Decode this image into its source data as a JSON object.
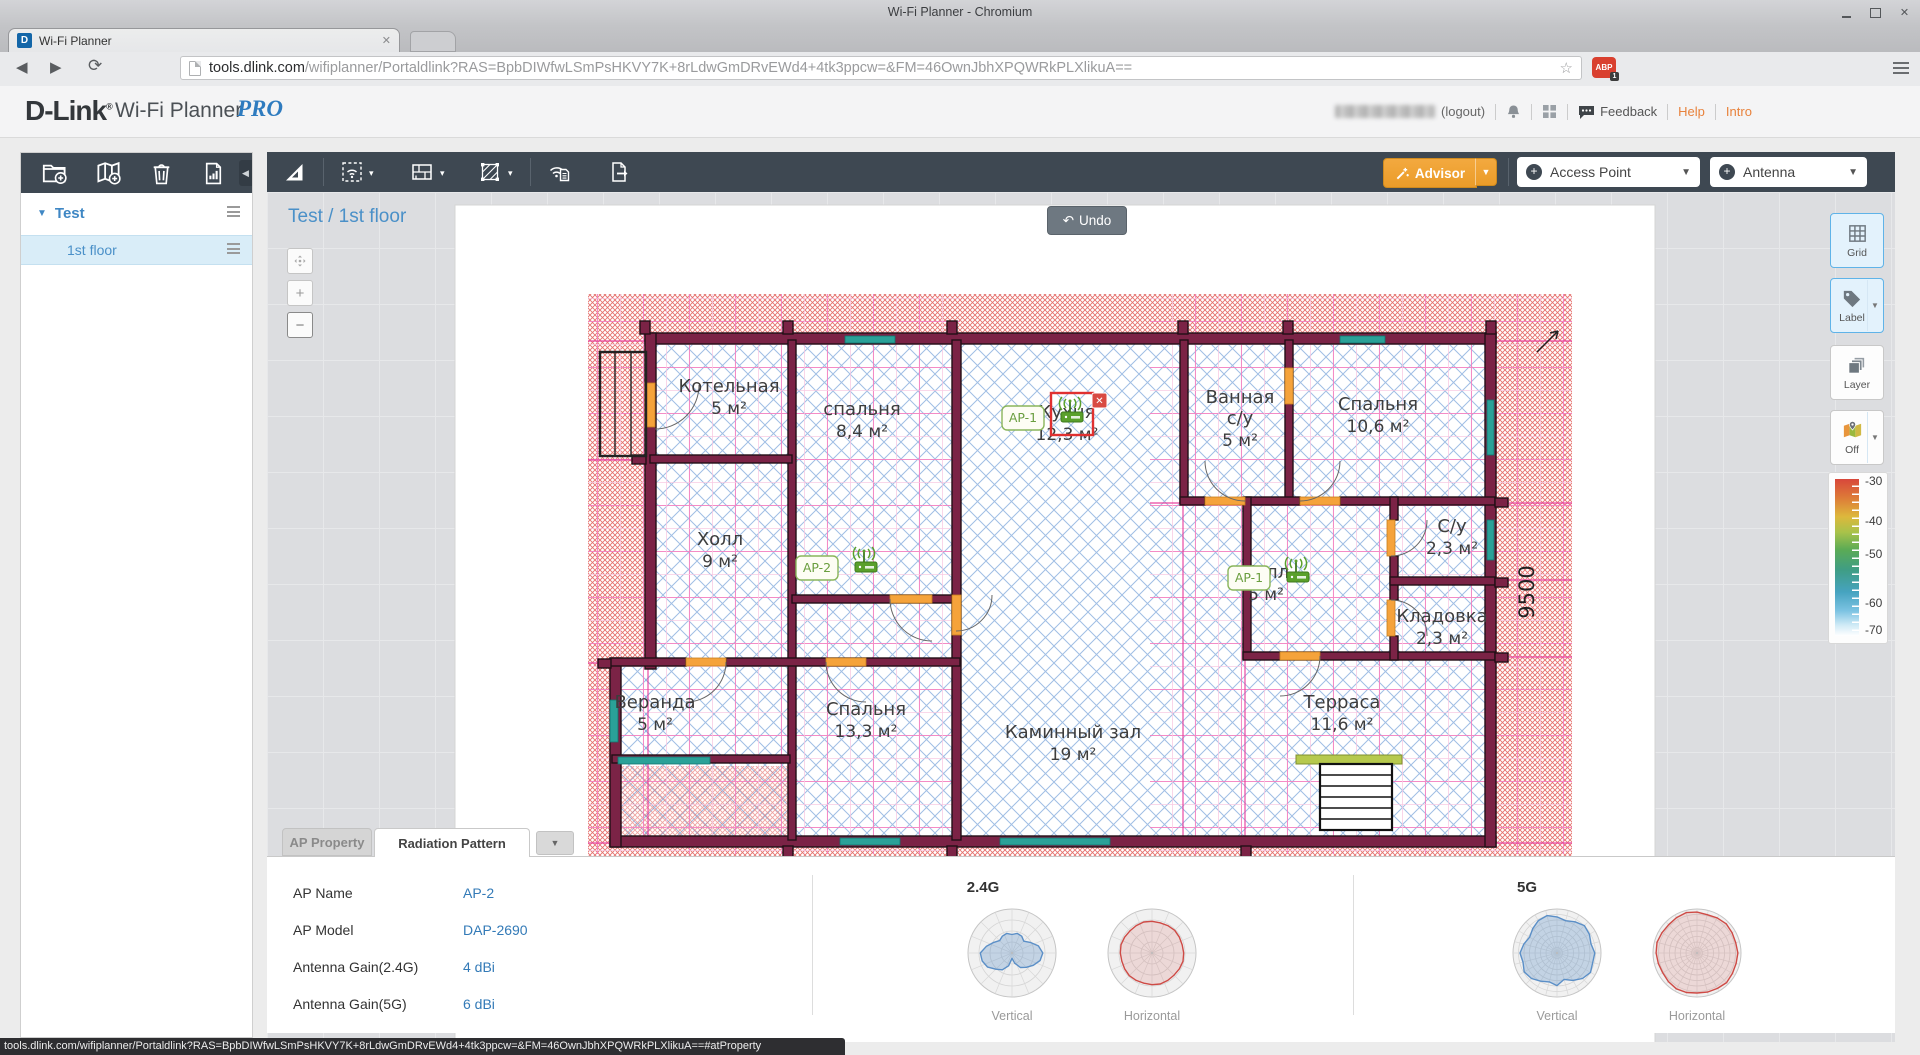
{
  "window": {
    "title": "Wi-Fi Planner - Chromium"
  },
  "browser": {
    "tab_title": "Wi-Fi Planner",
    "url_host": "tools.dlink.com",
    "url_path": "/wifiplanner/Portaldlink?RAS=BpbDIWfwLSmPsHKVY7K+8rLdwGmDRvEWd4+4tk3ppcw=&FM=46OwnJbhXPQWRkPLXlikuA==",
    "abp_label": "ABP",
    "abp_badge": "1"
  },
  "header": {
    "logo": "D-Link",
    "product": "Wi-Fi Planner",
    "edition": "PRO",
    "logout_label": "(logout)",
    "feedback_label": "Feedback",
    "help_label": "Help",
    "intro_label": "Intro"
  },
  "sidebar": {
    "project_label": "Test",
    "floor_label": "1st floor"
  },
  "toolbar": {
    "advisor_label": "Advisor",
    "access_point_label": "Access Point",
    "antenna_label": "Antenna"
  },
  "canvas": {
    "breadcrumb": "Test / 1st floor",
    "undo_label": "Undo"
  },
  "right_panel": {
    "grid_label": "Grid",
    "label_label": "Label",
    "layer_label": "Layer",
    "off_label": "Off",
    "scale_ticks": [
      "-30",
      "-40",
      "-50",
      "-60",
      "-70"
    ]
  },
  "plan": {
    "dimension": "9500",
    "rooms": [
      {
        "name": "Котельная",
        "area": "5 м²",
        "x": 729,
        "y": 392
      },
      {
        "name": "спальня",
        "area": "8,4 м²",
        "x": 862,
        "y": 415
      },
      {
        "name": "Кухня",
        "area": "12,3 м²",
        "x": 1067,
        "y": 418
      },
      {
        "name": "Ванная",
        "name2": "с/у",
        "area": "5 м²",
        "x": 1240,
        "y": 403
      },
      {
        "name": "Спальня",
        "area": "10,6 м²",
        "x": 1378,
        "y": 410
      },
      {
        "name": "Холл",
        "area": "9 м²",
        "x": 720,
        "y": 545
      },
      {
        "name": "Холл",
        "area": "5 м²",
        "x": 1266,
        "y": 578
      },
      {
        "name": "С/у",
        "area": "2,3 м²",
        "x": 1452,
        "y": 532
      },
      {
        "name": "Кладовка",
        "area": "2,3 м²",
        "x": 1442,
        "y": 622
      },
      {
        "name": "Веранда",
        "area": "5 м²",
        "x": 655,
        "y": 708
      },
      {
        "name": "Спальня",
        "area": "13,3 м²",
        "x": 866,
        "y": 715
      },
      {
        "name": "Каминный зал",
        "area": "19 м²",
        "x": 1073,
        "y": 738
      },
      {
        "name": "Терраса",
        "area": "11,6 м²",
        "x": 1342,
        "y": 708
      }
    ],
    "aps": [
      {
        "label": "AP-1",
        "x": 1072,
        "y": 418,
        "selected": true
      },
      {
        "label": "AP-2",
        "x": 866,
        "y": 568,
        "selected": false
      },
      {
        "label": "AP-1",
        "x": 1298,
        "y": 578,
        "selected": false
      }
    ]
  },
  "panel": {
    "tab_ap_property": "AP Property",
    "tab_radiation": "Radiation Pattern",
    "fields": [
      {
        "label": "AP Name",
        "value": "AP-2"
      },
      {
        "label": "AP Model",
        "value": "DAP-2690"
      },
      {
        "label": "Antenna Gain(2.4G)",
        "value": "4 dBi"
      },
      {
        "label": "Antenna Gain(5G)",
        "value": "6 dBi"
      }
    ],
    "sections": [
      {
        "title": "2.4G"
      },
      {
        "title": "5G"
      }
    ],
    "vertical_label": "Vertical",
    "horizontal_label": "Horizontal"
  },
  "chart_data": {
    "type": "radar",
    "title": "Antenna radiation patterns for DAP-2690",
    "charts": [
      {
        "band": "2.4G",
        "orientation": "Vertical",
        "rings": 4,
        "spokes": 16,
        "color": "#5b8fc7",
        "fill": "rgba(91,143,199,0.30)",
        "radii": [
          0.7,
          0.62,
          0.48,
          0.38,
          0.44,
          0.46,
          0.42,
          0.46,
          0.44,
          0.4,
          0.48,
          0.6,
          0.72,
          0.7,
          0.64,
          0.52,
          0.44,
          0.3,
          0.12,
          0.24,
          0.38,
          0.46,
          0.56,
          0.66
        ]
      },
      {
        "band": "2.4G",
        "orientation": "Horizontal",
        "rings": 4,
        "spokes": 16,
        "color": "#ce4a45",
        "fill": "rgba(206,74,69,0.15)",
        "radii": [
          0.72,
          0.71,
          0.72,
          0.73,
          0.72,
          0.71,
          0.72,
          0.73,
          0.72,
          0.71,
          0.72,
          0.73,
          0.72,
          0.71,
          0.72,
          0.73,
          0.72,
          0.71,
          0.72,
          0.73,
          0.72,
          0.71,
          0.72,
          0.73
        ]
      },
      {
        "band": "5G",
        "orientation": "Vertical",
        "rings": 8,
        "spokes": 24,
        "color": "#5b8fc7",
        "fill": "rgba(91,143,199,0.30)",
        "radii": [
          0.86,
          0.8,
          0.85,
          0.88,
          0.82,
          0.76,
          0.82,
          0.88,
          0.85,
          0.78,
          0.72,
          0.78,
          0.84,
          0.8,
          0.86,
          0.82,
          0.74,
          0.68,
          0.74,
          0.62,
          0.72,
          0.82,
          0.88,
          0.84
        ]
      },
      {
        "band": "5G",
        "orientation": "Horizontal",
        "rings": 8,
        "spokes": 24,
        "color": "#ce4a45",
        "fill": "rgba(206,74,69,0.15)",
        "radii": [
          0.93,
          0.91,
          0.92,
          0.94,
          0.92,
          0.9,
          0.93,
          0.95,
          0.93,
          0.91,
          0.92,
          0.94,
          0.93,
          0.91,
          0.9,
          0.92,
          0.94,
          0.93,
          0.91,
          0.92,
          0.93,
          0.95,
          0.93,
          0.92
        ]
      }
    ]
  },
  "statusbar": {
    "text": "tools.dlink.com/wifiplanner/Portaldlink?RAS=BpbDIWfwLSmPsHKVY7K+8rLdwGmDRvEWd4+4tk3ppcw=&FM=46OwnJbhXPQWRkPLXlikuA==#atProperty"
  }
}
